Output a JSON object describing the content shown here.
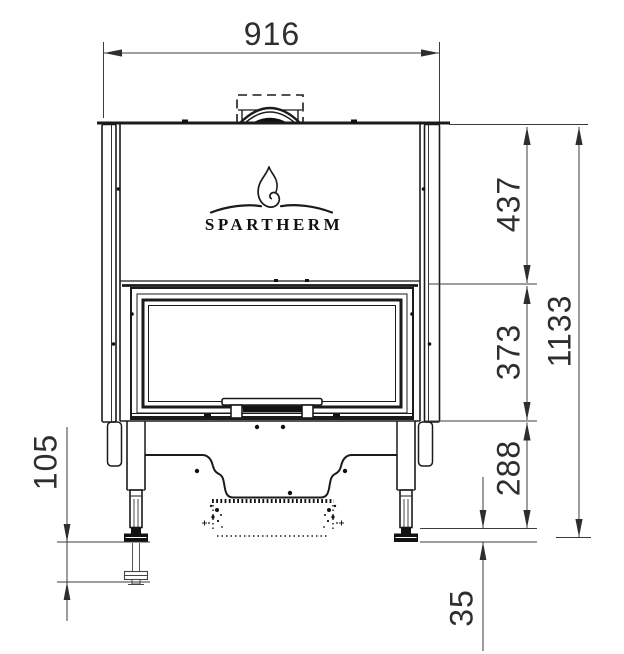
{
  "drawing": {
    "brand": "SPARTHERM",
    "dims": {
      "total_width": "916",
      "hood_height": "437",
      "door_height": "373",
      "base_height": "288",
      "total_height": "1133",
      "leg_adjustment": "105",
      "foot_height": "35"
    }
  }
}
